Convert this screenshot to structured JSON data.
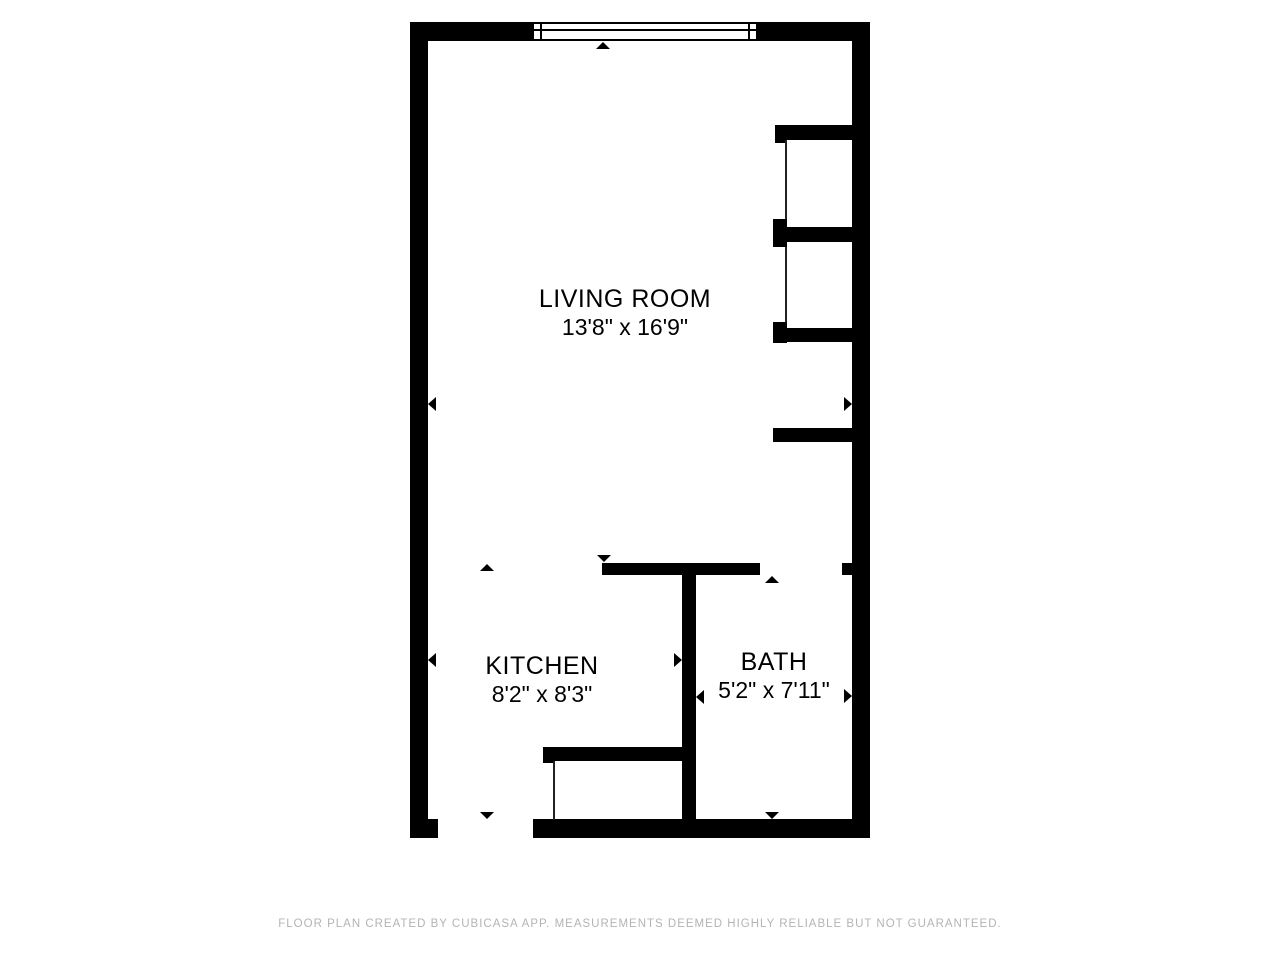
{
  "plan": {
    "rooms": [
      {
        "name": "LIVING ROOM",
        "dimensions": "13'8\" x 16'9\""
      },
      {
        "name": "KITCHEN",
        "dimensions": "8'2\" x 8'3\""
      },
      {
        "name": "BATH",
        "dimensions": "5'2\" x 7'11\""
      }
    ]
  },
  "footer": {
    "credit": "FLOOR PLAN CREATED BY CUBICASA APP. MEASUREMENTS DEEMED HIGHLY RELIABLE BUT NOT GUARANTEED."
  },
  "colors": {
    "wall": "#000000",
    "background": "#ffffff",
    "room_text": "#000000",
    "footer_text": "#b4b4b4"
  }
}
